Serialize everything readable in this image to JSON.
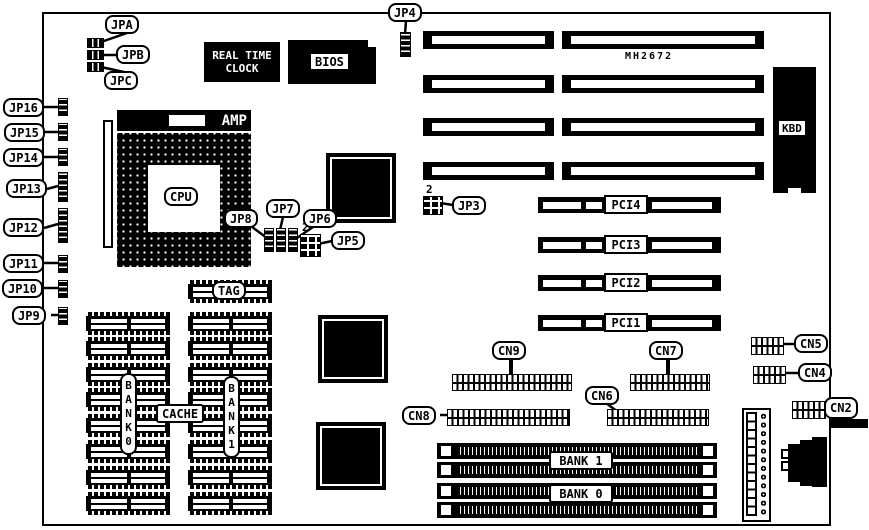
{
  "labels": {
    "jpa": "JPA",
    "jpb": "JPB",
    "jpc": "JPC",
    "jp3": "JP3",
    "jp4": "JP4",
    "jp5": "JP5",
    "jp6": "JP6",
    "jp7": "JP7",
    "jp8": "JP8",
    "jp9": "JP9",
    "jp10": "JP10",
    "jp11": "JP11",
    "jp12": "JP12",
    "jp13": "JP13",
    "jp14": "JP14",
    "jp15": "JP15",
    "jp16": "JP16",
    "cn2": "CN2",
    "cn4": "CN4",
    "cn5": "CN5",
    "cn6": "CN6",
    "cn7": "CN7",
    "cn8": "CN8",
    "cn9": "CN9",
    "pin2_jp3": "2",
    "pin2_jp5": "2"
  },
  "chips": {
    "rtc_line1": "REAL TIME",
    "rtc_line2": "CLOCK",
    "bios": "BIOS",
    "cpu": "CPU",
    "socket_brand": "AMP",
    "chipset": "MH2672",
    "kbd": "KBD",
    "tag": "TAG",
    "cache": "CACHE",
    "bank0_column": "BANK0",
    "bank1_column": "BANK1"
  },
  "slots": {
    "pci": [
      "PCI4",
      "PCI3",
      "PCI2",
      "PCI1"
    ],
    "simm_bank1": "BANK 1",
    "simm_bank0": "BANK 0"
  }
}
